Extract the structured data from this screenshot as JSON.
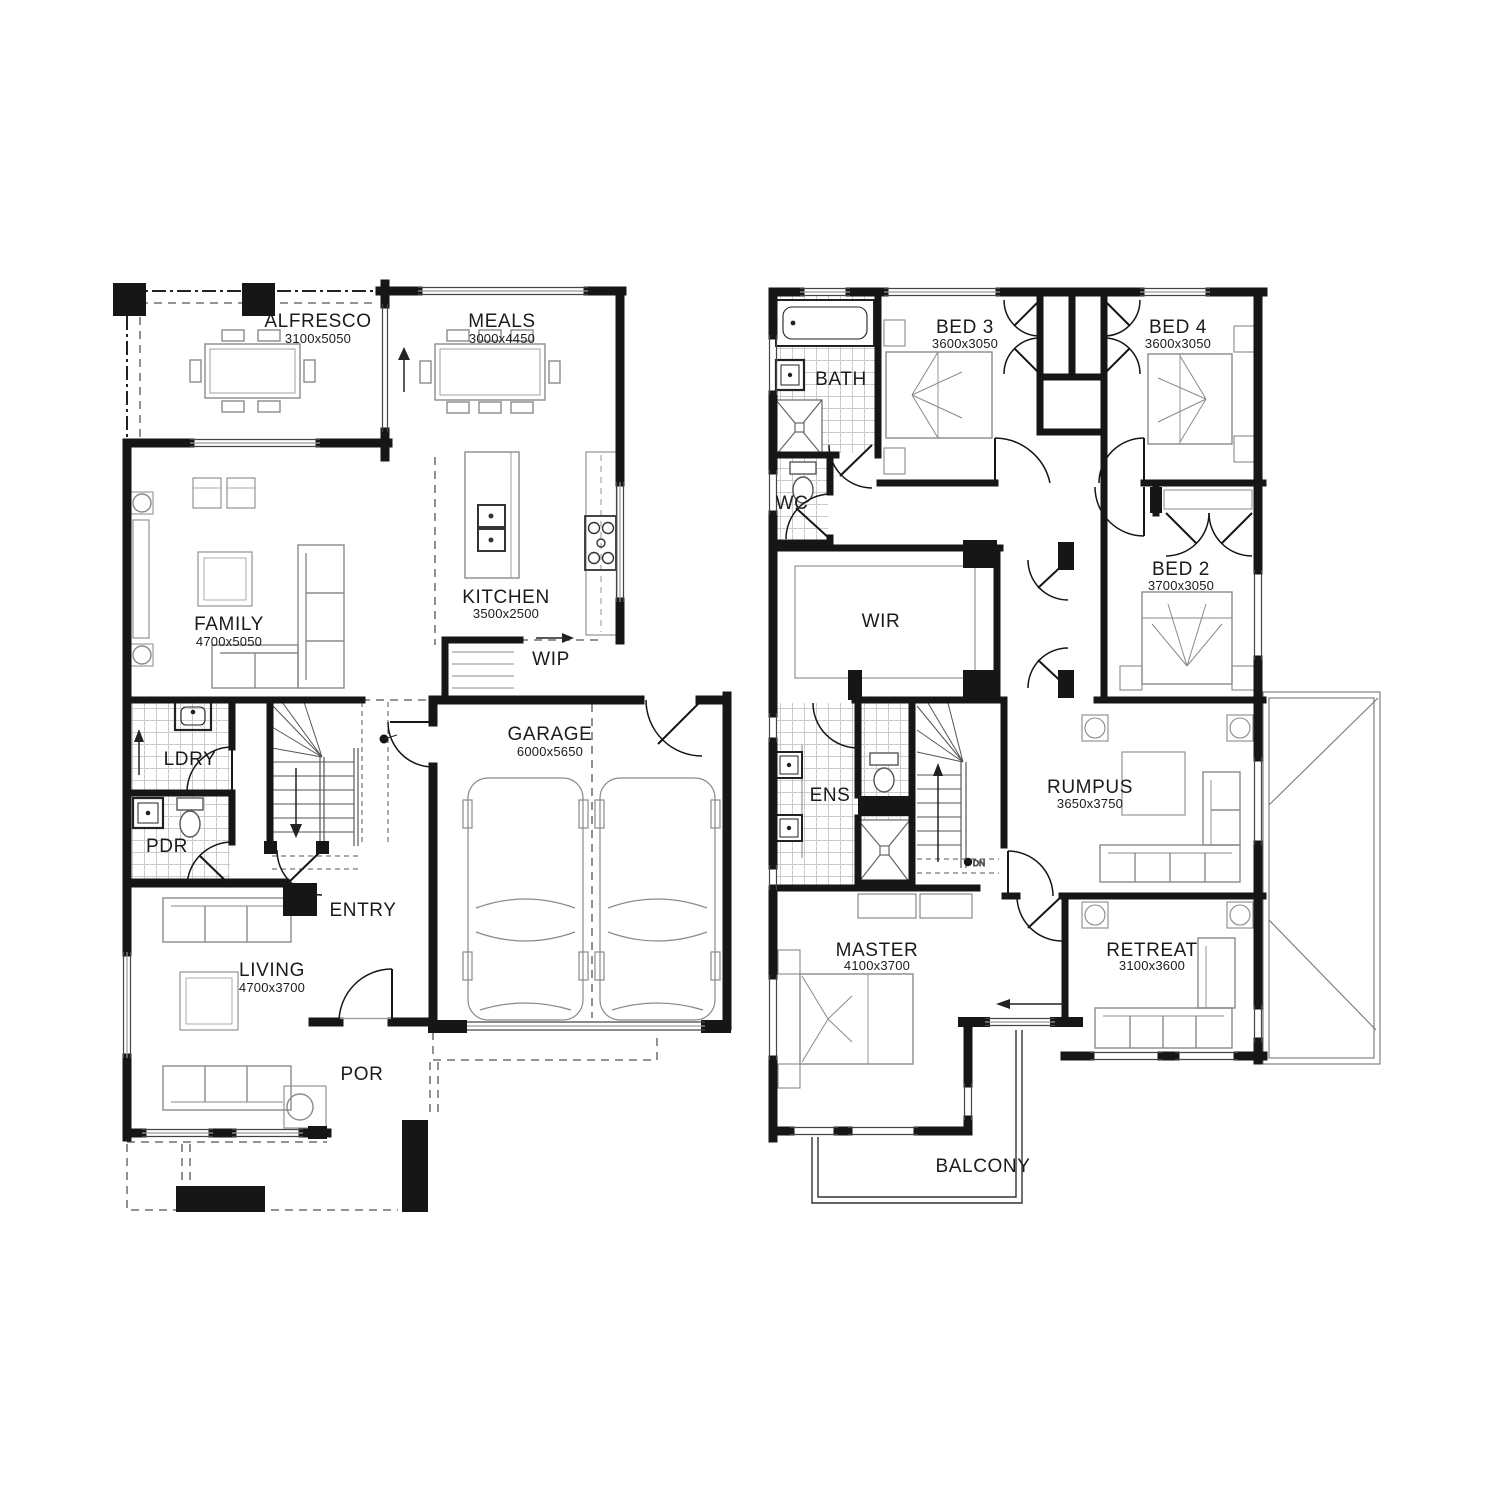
{
  "meta": {
    "background": "#ffffff",
    "wall_color": "#161616",
    "furniture_color": "#8a8a8a",
    "tile_color": "#c9c9c9",
    "dash_color": "#555555"
  },
  "ground_floor": {
    "rooms": [
      {
        "id": "alfresco",
        "name": "ALFRESCO",
        "dims": "3100x5050"
      },
      {
        "id": "meals",
        "name": "MEALS",
        "dims": "3000x4450"
      },
      {
        "id": "family",
        "name": "FAMILY",
        "dims": "4700x5050"
      },
      {
        "id": "kitchen",
        "name": "KITCHEN",
        "dims": "3500x2500"
      },
      {
        "id": "wip",
        "name": "WIP",
        "dims": ""
      },
      {
        "id": "garage",
        "name": "GARAGE",
        "dims": "6000x5650"
      },
      {
        "id": "ldry",
        "name": "LDRY",
        "dims": ""
      },
      {
        "id": "pdr",
        "name": "PDR",
        "dims": ""
      },
      {
        "id": "entry",
        "name": "ENTRY",
        "dims": ""
      },
      {
        "id": "living",
        "name": "LIVING",
        "dims": "4700x3700"
      },
      {
        "id": "por",
        "name": "POR",
        "dims": ""
      }
    ]
  },
  "first_floor": {
    "rooms": [
      {
        "id": "bath",
        "name": "BATH",
        "dims": ""
      },
      {
        "id": "bed3",
        "name": "BED 3",
        "dims": "3600x3050"
      },
      {
        "id": "bed4",
        "name": "BED 4",
        "dims": "3600x3050"
      },
      {
        "id": "wc",
        "name": "WC",
        "dims": ""
      },
      {
        "id": "wir",
        "name": "WIR",
        "dims": ""
      },
      {
        "id": "bed2",
        "name": "BED 2",
        "dims": "3700x3050"
      },
      {
        "id": "ens",
        "name": "ENS",
        "dims": ""
      },
      {
        "id": "rumpus",
        "name": "RUMPUS",
        "dims": "3650x3750"
      },
      {
        "id": "master",
        "name": "MASTER",
        "dims": "4100x3700"
      },
      {
        "id": "retreat",
        "name": "RETREAT",
        "dims": "3100x3600"
      },
      {
        "id": "balcony",
        "name": "BALCONY",
        "dims": ""
      }
    ],
    "stairs_note": "DN"
  }
}
